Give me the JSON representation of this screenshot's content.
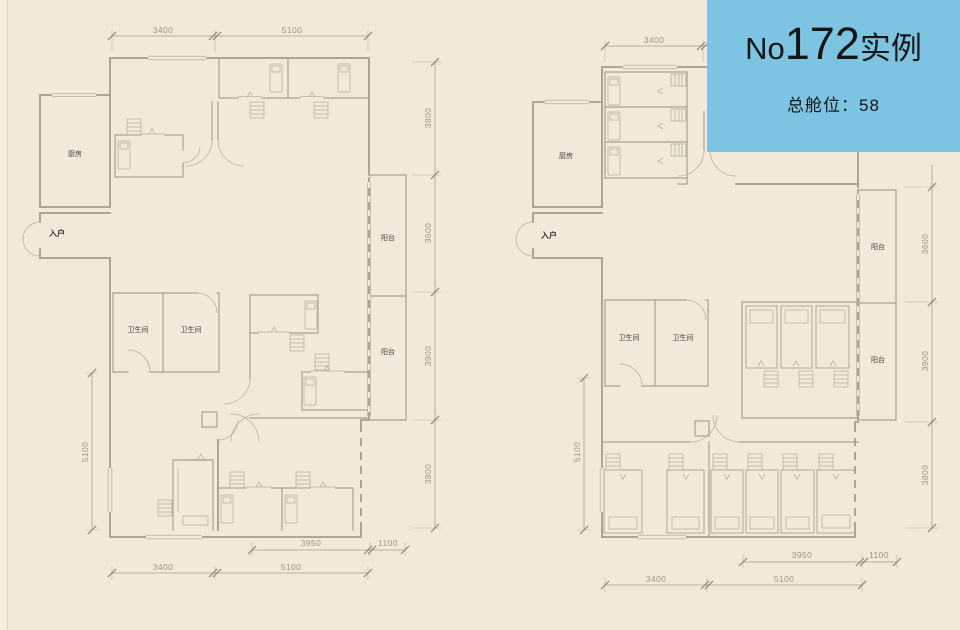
{
  "banner": {
    "no_prefix": "No",
    "number": "172",
    "type_label": "实例",
    "capacity": "总舱位：58",
    "bg_color": "#7cc4e1",
    "text_color": "#161616"
  },
  "colors": {
    "page_background": "#f2e9d8",
    "wall_line": "#a49c8d",
    "dimension_text": "#9f9684"
  },
  "plans": {
    "left": {
      "labels": {
        "kitchen": "厨房",
        "entry": "入户",
        "bath_left": "卫生间",
        "bath_right": "卫生间",
        "balcony_top": "阳台",
        "balcony_bottom": "阳台"
      },
      "dims": {
        "top": [
          "3400",
          "5100"
        ],
        "right": [
          "3800",
          "3600",
          "3900",
          "3800"
        ],
        "bottom_inner": [
          "3950",
          "1100"
        ],
        "bottom_outer": [
          "3400",
          "5100"
        ],
        "left": [
          "5100"
        ]
      }
    },
    "right": {
      "labels": {
        "kitchen": "厨房",
        "entry": "入户",
        "bath_left": "卫生间",
        "bath_right": "卫生间",
        "balcony_top": "阳台",
        "balcony_bottom": "阳台"
      },
      "dims": {
        "top": [
          "3400"
        ],
        "right": [
          "3600",
          "3900",
          "3800"
        ],
        "bottom_inner": [
          "3950",
          "1100"
        ],
        "bottom_outer": [
          "3400",
          "5100"
        ],
        "left": [
          "5100"
        ]
      }
    }
  }
}
